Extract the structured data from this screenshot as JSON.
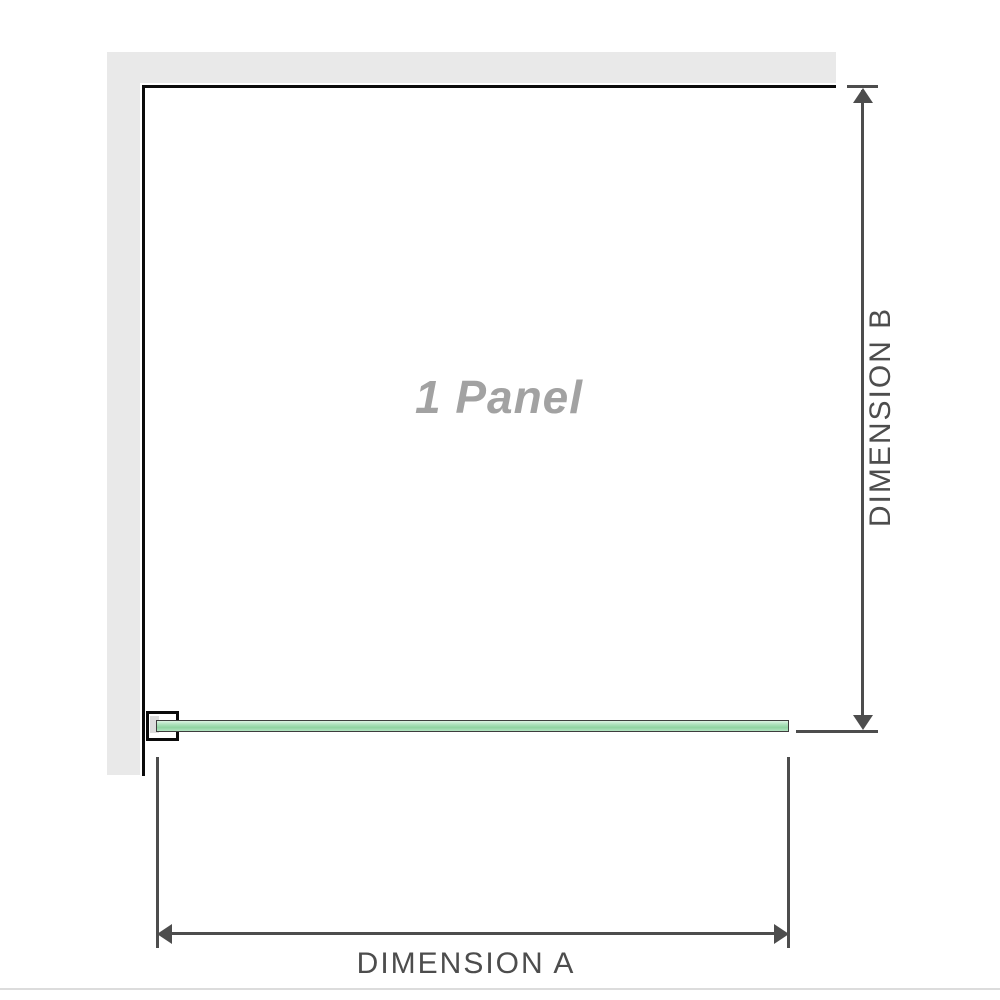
{
  "diagram": {
    "panel_label": "1 Panel",
    "dimension_a": {
      "label": "DIMENSION A",
      "axis": "horizontal"
    },
    "dimension_b": {
      "label": "DIMENSION B",
      "axis": "vertical"
    }
  },
  "colors": {
    "wall_gray": "#e9e9e9",
    "frame_black": "#0b0b0b",
    "line_dark": "#4d4d4d",
    "text_dark": "#4d4d4d",
    "label_gray": "#a2a2a2",
    "bracket_gray": "#dcdcdc",
    "glass_border": "#3d3d3d",
    "glass_light": "#ddf3e3",
    "glass_mid": "#b2e3c0",
    "glass_deep": "#8fd3a1",
    "divider_gray": "#dcdcdc"
  }
}
